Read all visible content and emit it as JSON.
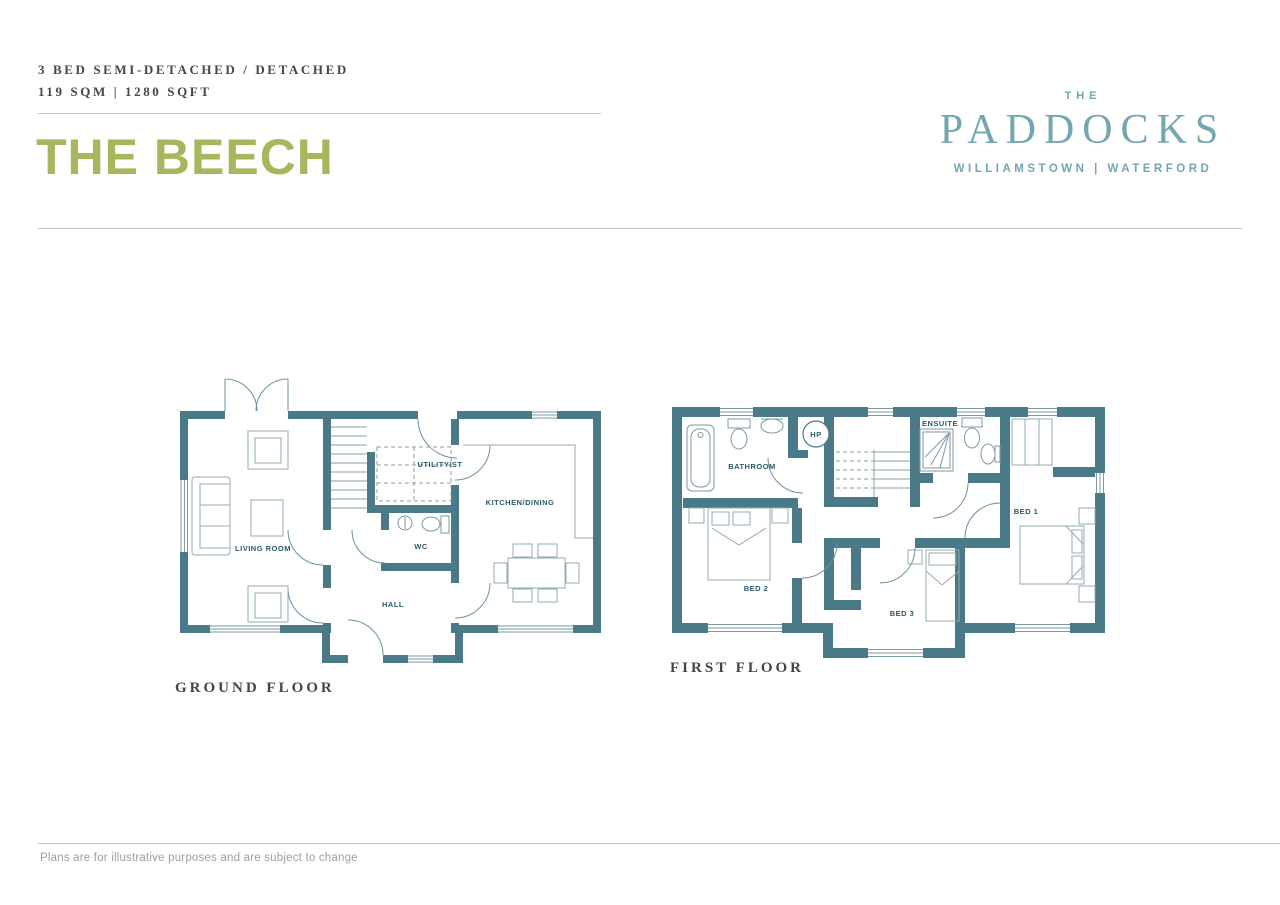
{
  "header": {
    "spec_line1": "3 BED SEMI-DETACHED / DETACHED",
    "spec_line2": "119 SQM | 1280 SQFT",
    "plan_name": "THE BEECH"
  },
  "brand": {
    "prefix": "THE",
    "name": "PADDOCKS",
    "location": "WILLIAMSTOWN | WATERFORD"
  },
  "ground_floor": {
    "caption": "GROUND FLOOR",
    "rooms": {
      "living_room": "LIVING ROOM",
      "utility": "UTILITY/ST",
      "wc": "WC",
      "hall": "HALL",
      "kitchen_dining": "KITCHEN/DINING"
    }
  },
  "first_floor": {
    "caption": "FIRST FLOOR",
    "rooms": {
      "bathroom": "BATHROOM",
      "hp": "HP",
      "ensuite": "ENSUITE",
      "bed1": "BED 1",
      "bed2": "BED 2",
      "bed3": "BED 3"
    }
  },
  "footer": {
    "disclaimer": "Plans are for illustrative purposes and are subject to change"
  },
  "colors": {
    "wall_teal": "#4a7a87",
    "label_teal": "#2a5a68",
    "brand_teal": "#73a6b1",
    "accent_green": "#a6b85e"
  }
}
